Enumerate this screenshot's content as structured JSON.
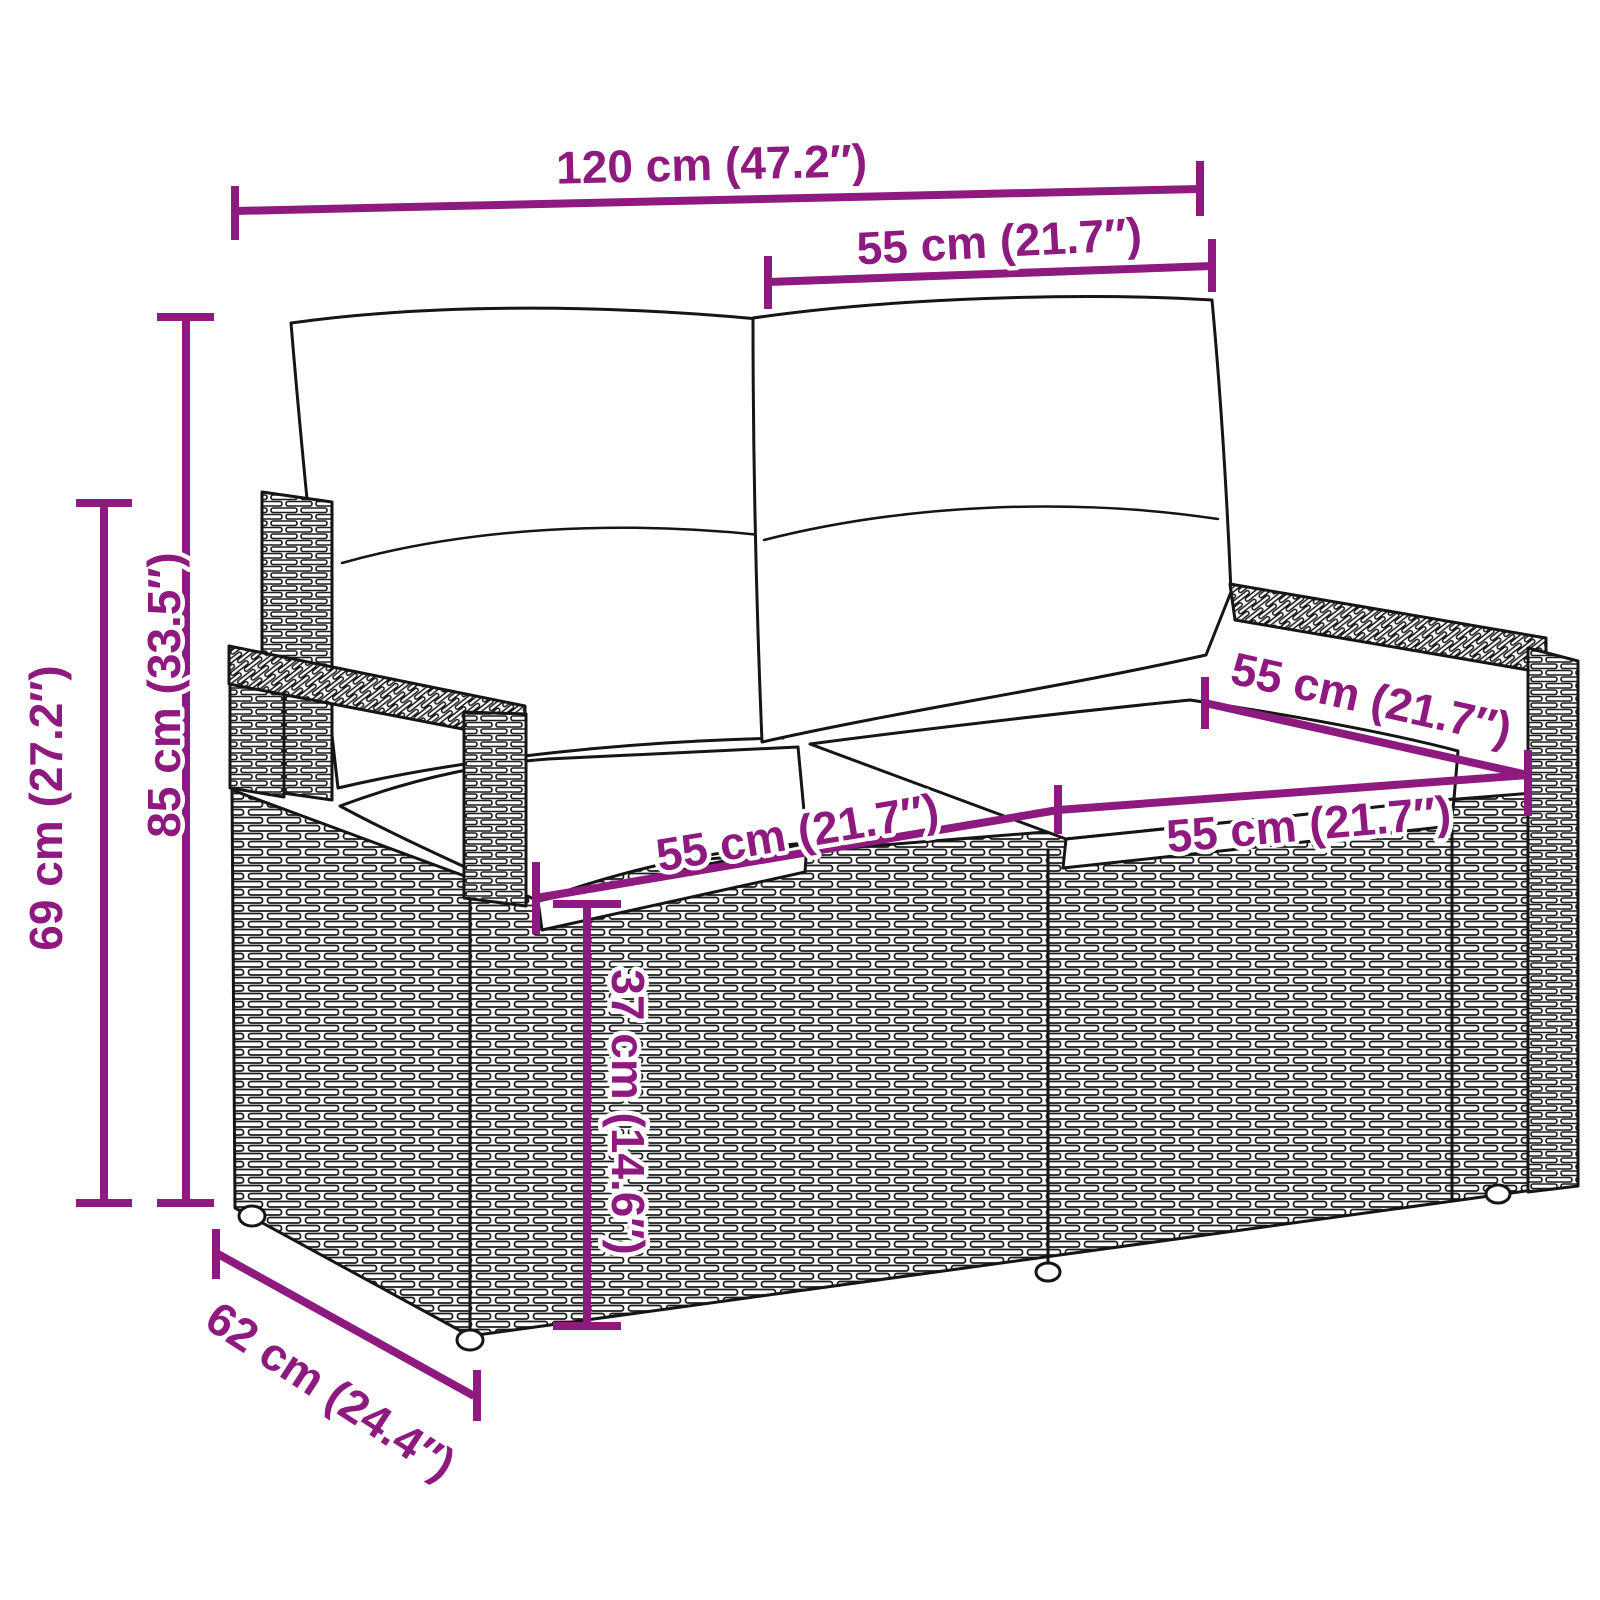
{
  "figure": {
    "subject": "poly rattan two-seater garden bench with back and seat cushions",
    "style": "black-and-white technical line drawing, three-quarter perspective",
    "annotation_unit": "cm (inches)"
  },
  "colors": {
    "dimension_accent": "#8E1A7F",
    "drawing_line": "#151515",
    "background": "#FFFFFF"
  },
  "dimensions": {
    "overall_width": {
      "cm": 120,
      "in": 47.2,
      "label": "120 cm (47.2″)"
    },
    "back_section_width": {
      "cm": 55,
      "in": 21.7,
      "label": "55 cm (21.7″)"
    },
    "total_height": {
      "cm": 85,
      "in": 33.5,
      "label": "85 cm (33.5″)"
    },
    "frame_height": {
      "cm": 69,
      "in": 27.2,
      "label": "69 cm (27.2″)"
    },
    "depth": {
      "cm": 62,
      "in": 24.4,
      "label": "62 cm (24.4″)"
    },
    "seat_width_left": {
      "cm": 55,
      "in": 21.7,
      "label": "55 cm (21.7″)"
    },
    "seat_width_right": {
      "cm": 55,
      "in": 21.7,
      "label": "55 cm (21.7″)"
    },
    "seat_depth": {
      "cm": 55,
      "in": 21.7,
      "label": "55 cm (21.7″)"
    },
    "seat_height": {
      "cm": 37,
      "in": 14.6,
      "label": "37 cm (14.6″)"
    }
  }
}
